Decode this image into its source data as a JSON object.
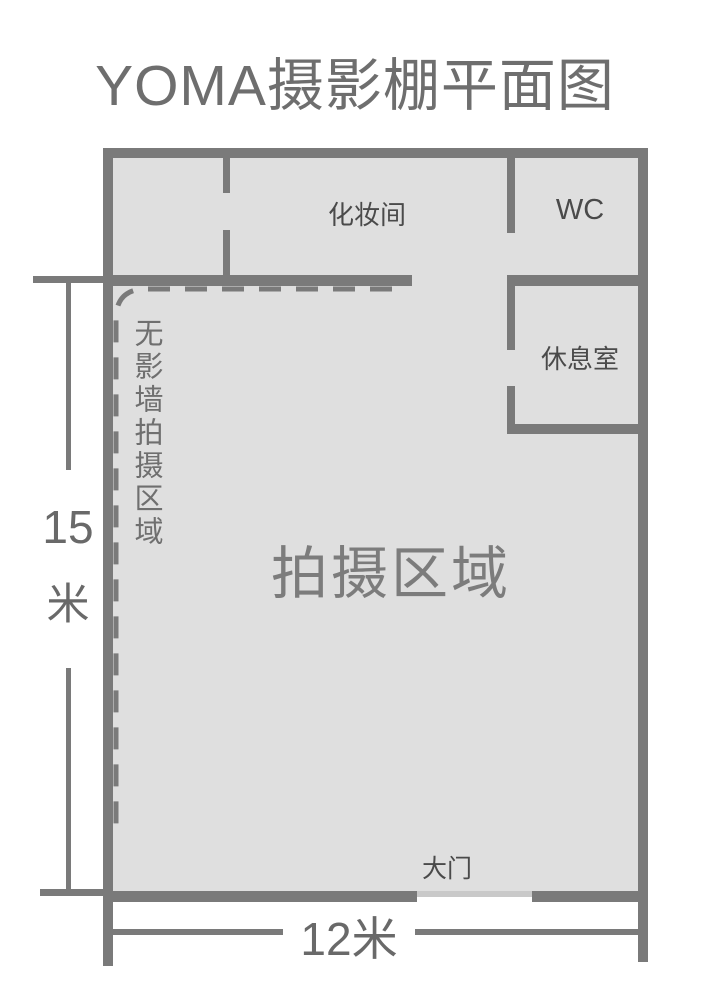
{
  "title": "YOMA摄影棚平面图",
  "rooms": {
    "makeup": "化妆间",
    "wc": "WC",
    "rest": "休息室",
    "shooting": "拍摄区域",
    "seamless_wall_area": "无影墙拍摄区域",
    "main_door": "大门"
  },
  "dimensions": {
    "height_value": "15",
    "height_unit": "米",
    "width_label": "12米"
  },
  "colors": {
    "wall": "#7a7a7a",
    "floor": "#dfdfdf",
    "threshold": "#c9c9c9",
    "title_text": "#6e6e6e",
    "room_label": "#4a4a4a",
    "area_label": "#7c7c7c",
    "side_label": "#6f6f6f",
    "dim_text": "#696969"
  }
}
